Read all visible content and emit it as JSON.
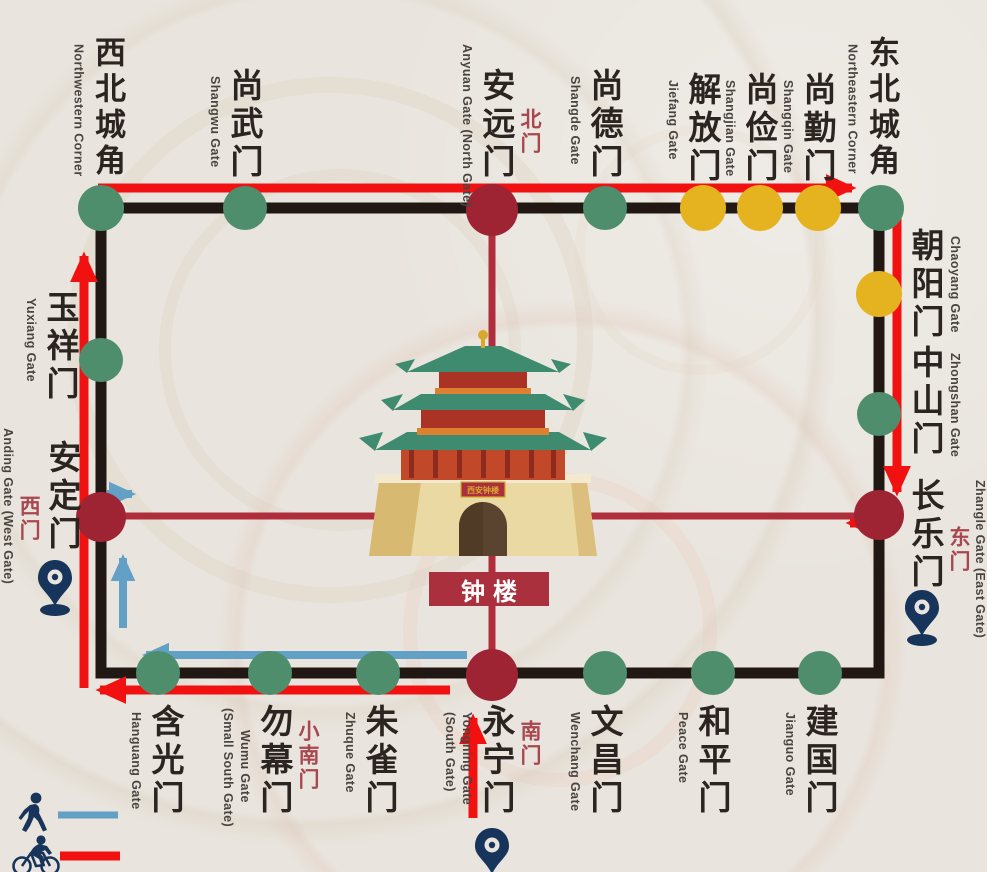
{
  "colors": {
    "paper": "#e9e5de",
    "wall": "#211713",
    "gate_green": "#4e8e6d",
    "gate_yellow": "#e5b31f",
    "gate_red": "#9e2433",
    "axis_red": "#b02e3c",
    "route_red": "#f21111",
    "route_blue": "#62a0c6",
    "pin_navy": "#17355a",
    "label_dark": "#2b2421",
    "label_en": "#494440",
    "alt_red": "#a8474f",
    "plaque_bg": "#a9303c",
    "plaque_text": "#ffffff",
    "roof_green": "#3e8b70",
    "tower_red": "#ab3325",
    "tower_orange": "#dd8030",
    "base_cream": "#ead9a2",
    "door_brown": "#5a4430",
    "gold": "#d8a92c"
  },
  "center": {
    "plaque": "钟楼",
    "building_plaque": "西安钟楼"
  },
  "gates": {
    "top": [
      {
        "zh": "西北城角",
        "en": "Northwestern Corner",
        "dot": "green"
      },
      {
        "zh": "尚武门",
        "en": "Shangwu Gate",
        "dot": "green"
      },
      {
        "zh": "安远门",
        "en": "Anyuan Gate (North Gate)",
        "alt": "北门",
        "dot": "red"
      },
      {
        "zh": "尚德门",
        "en": "Shangde Gate",
        "dot": "green"
      },
      {
        "zh": "解放门",
        "en": "Jiefang Gate",
        "dot": "yellow"
      },
      {
        "zh": "尚俭门",
        "en": "Shangjian Gate",
        "dot": "yellow"
      },
      {
        "zh": "尚勤门",
        "en": "Shangqin Gate",
        "dot": "yellow"
      },
      {
        "zh": "东北城角",
        "en": "Northeastern Corner",
        "dot": "green"
      }
    ],
    "right": [
      {
        "zh": "朝阳门",
        "en": "Chaoyang Gate",
        "dot": "yellow"
      },
      {
        "zh": "中山门",
        "en": "Zhongshan Gate",
        "dot": "green"
      },
      {
        "zh": "长乐门",
        "en": "Zhangle Gate (East Gate)",
        "alt": "东门",
        "dot": "red"
      }
    ],
    "bottom": [
      {
        "zh": "含光门",
        "en": "Hanguang Gate",
        "dot": "green"
      },
      {
        "zh": "勿幕门",
        "en": "Wumu Gate",
        "en_sub": "(Small South Gate)",
        "alt": "小南门",
        "dot": "green"
      },
      {
        "zh": "朱雀门",
        "en": "Zhuque Gate",
        "dot": "green"
      },
      {
        "zh": "永宁门",
        "en": "Yongning Gate",
        "en_sub": "(South Gate)",
        "alt": "南门",
        "dot": "red"
      },
      {
        "zh": "文昌门",
        "en": "Wenchang Gate",
        "dot": "green"
      },
      {
        "zh": "和平门",
        "en": "Peace Gate",
        "dot": "green"
      },
      {
        "zh": "建国门",
        "en": "Jianguo Gate",
        "dot": "green"
      }
    ],
    "left": [
      {
        "zh": "玉祥门",
        "en": "Yuxiang Gate",
        "dot": "green"
      },
      {
        "zh": "安定门",
        "en": "Anding Gate (West Gate)",
        "alt": "西门",
        "dot": "red"
      }
    ]
  },
  "legend": {
    "items": [
      {
        "icon": "pedestrian-icon",
        "route_color_key": "route_blue"
      },
      {
        "icon": "cyclist-icon",
        "route_color_key": "route_red"
      }
    ]
  },
  "pins": {
    "icon": "location-pin-icon",
    "locations": [
      "west-gate",
      "east-gate",
      "south-gate"
    ]
  }
}
